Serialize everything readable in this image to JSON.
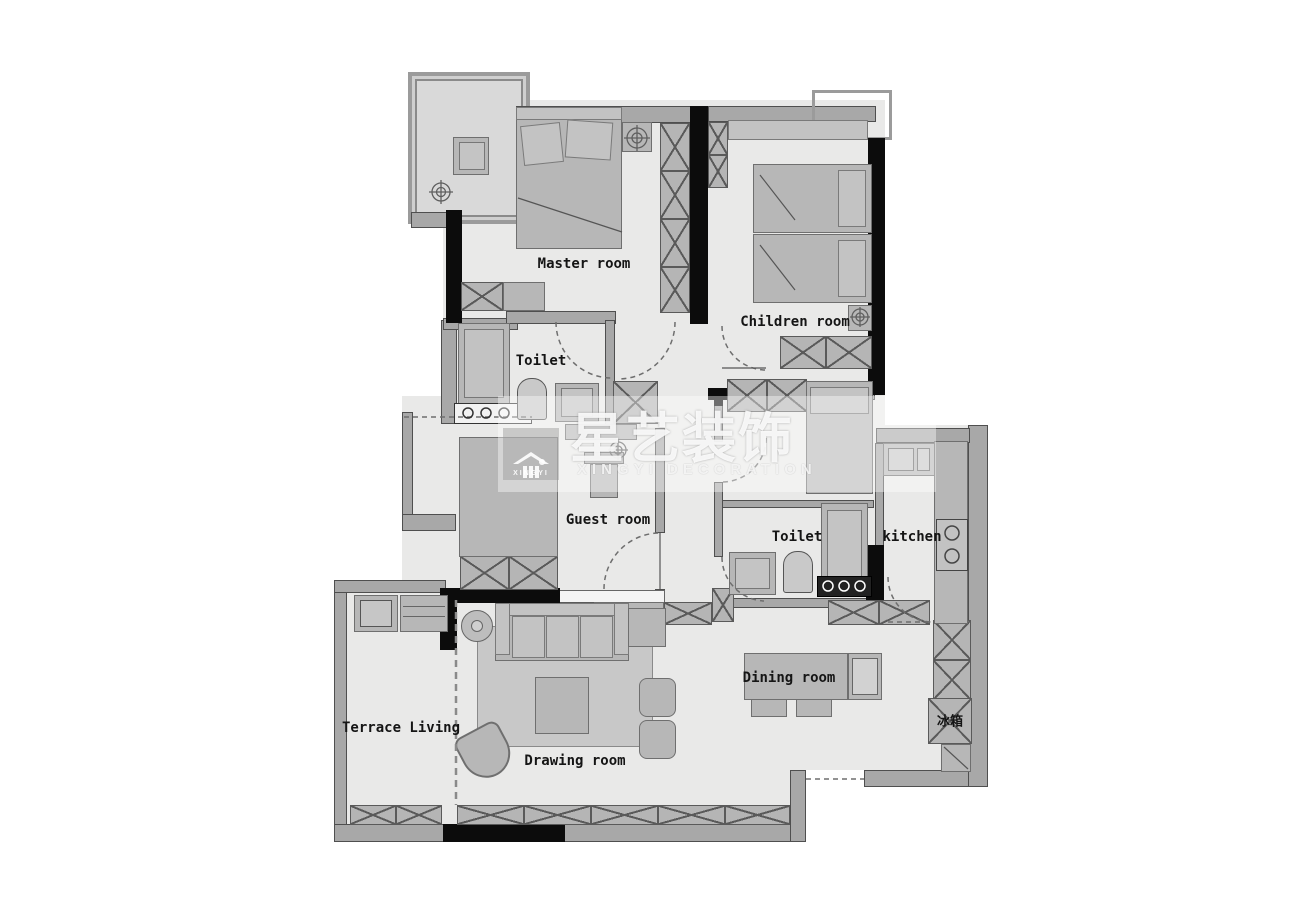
{
  "watermark": {
    "logo_text": "XINGYI",
    "brand_cn": "星艺装饰",
    "brand_en": "XINGYI DECORATION"
  },
  "rooms": {
    "master": {
      "label": "Master room"
    },
    "children": {
      "label": "Children room"
    },
    "toilet_left": {
      "label": "Toilet"
    },
    "guest": {
      "label": "Guest room"
    },
    "toilet_right": {
      "label": "Toilet"
    },
    "kitchen": {
      "label": "kitchen"
    },
    "dining": {
      "label": "Dining room"
    },
    "drawing": {
      "label": "Drawing room"
    },
    "terrace": {
      "label": "Terrace Living"
    }
  },
  "appliances": {
    "fridge": {
      "label": "冰箱"
    }
  },
  "colors": {
    "background": "#ffffff",
    "floor": "#e9e9e8",
    "wall": "#a8a8a8",
    "black_wall": "#0c0c0c",
    "furniture": "#b7b7b7"
  }
}
